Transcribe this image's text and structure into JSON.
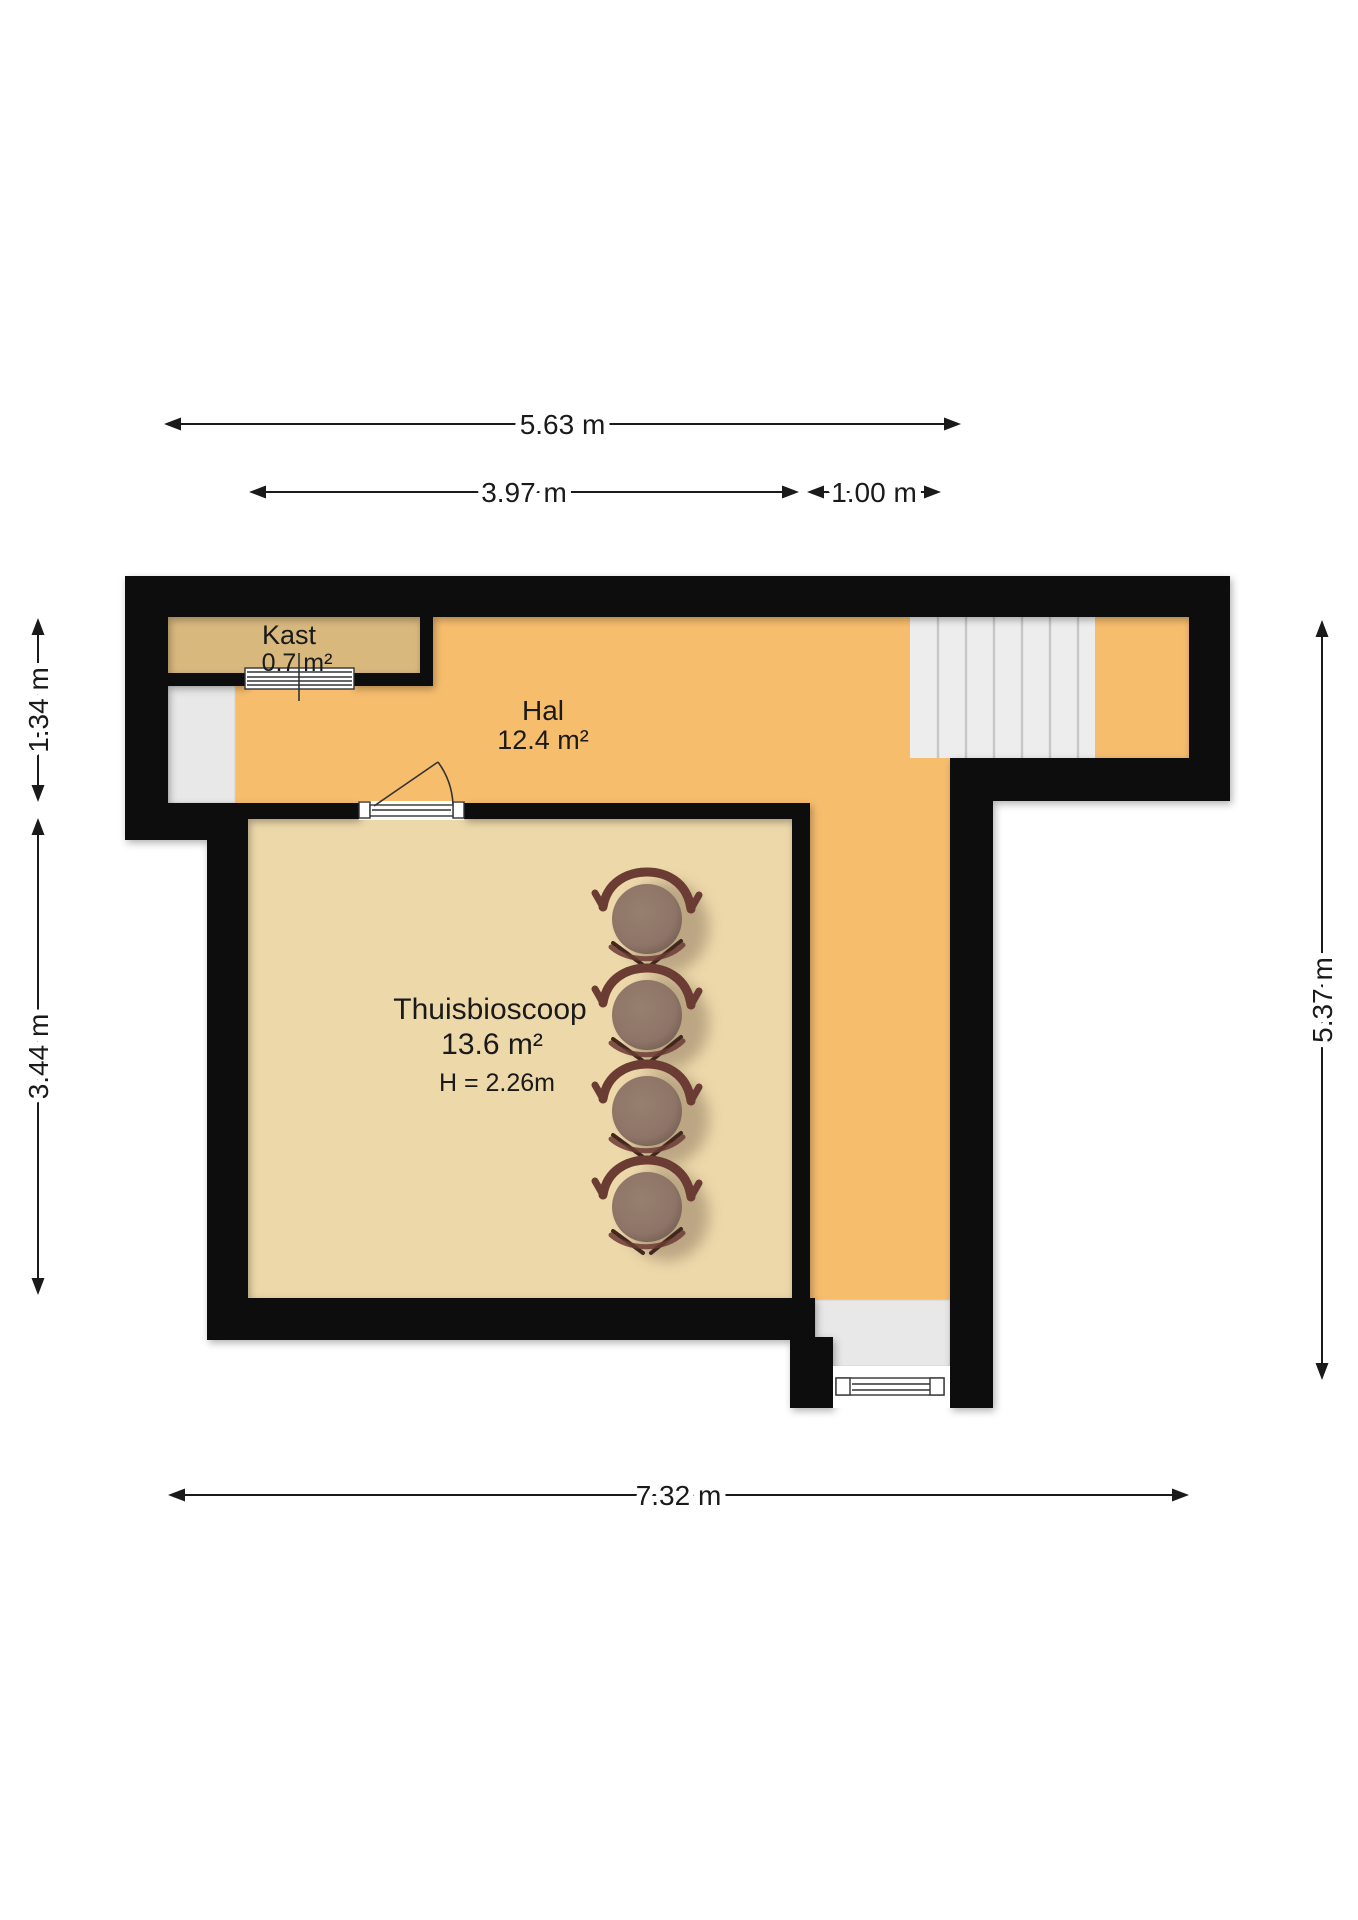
{
  "plan": {
    "type": "floor-plan",
    "rooms": [
      {
        "id": "kast",
        "name": "Kast",
        "area": "0.7 m²"
      },
      {
        "id": "hal",
        "name": "Hal",
        "area": "12.4 m²"
      },
      {
        "id": "thuisbioscoop",
        "name": "Thuisbioscoop",
        "area": "13.6 m²",
        "ceiling_height": "H = 2.26m"
      }
    ],
    "dimensions": [
      {
        "id": "top-width",
        "label": "5.63 m"
      },
      {
        "id": "room-width",
        "label": "3.97 m"
      },
      {
        "id": "corridor-width",
        "label": "1.00 m"
      },
      {
        "id": "upper-left-height",
        "label": "1.34 m"
      },
      {
        "id": "room-height",
        "label": "3.44 m"
      },
      {
        "id": "right-height",
        "label": "5.37 m"
      },
      {
        "id": "total-width",
        "label": "7.32 m"
      }
    ],
    "furniture": {
      "cinema_chairs": 4
    },
    "features": [
      "staircase",
      "entry-recess",
      "sliding-door",
      "swing-door",
      "bottom-exterior-door"
    ]
  },
  "colors": {
    "wall": "#0a0a0a",
    "hal_floor": "#f6bd6d",
    "kast_floor": "#d9b87e",
    "room_floor": "#edd8aa",
    "recess": "#e8e8e8",
    "stairs": "#ededed",
    "chair_seat": "#8d7467",
    "chair_frame": "#6b3c33",
    "background": "#ffffff"
  }
}
